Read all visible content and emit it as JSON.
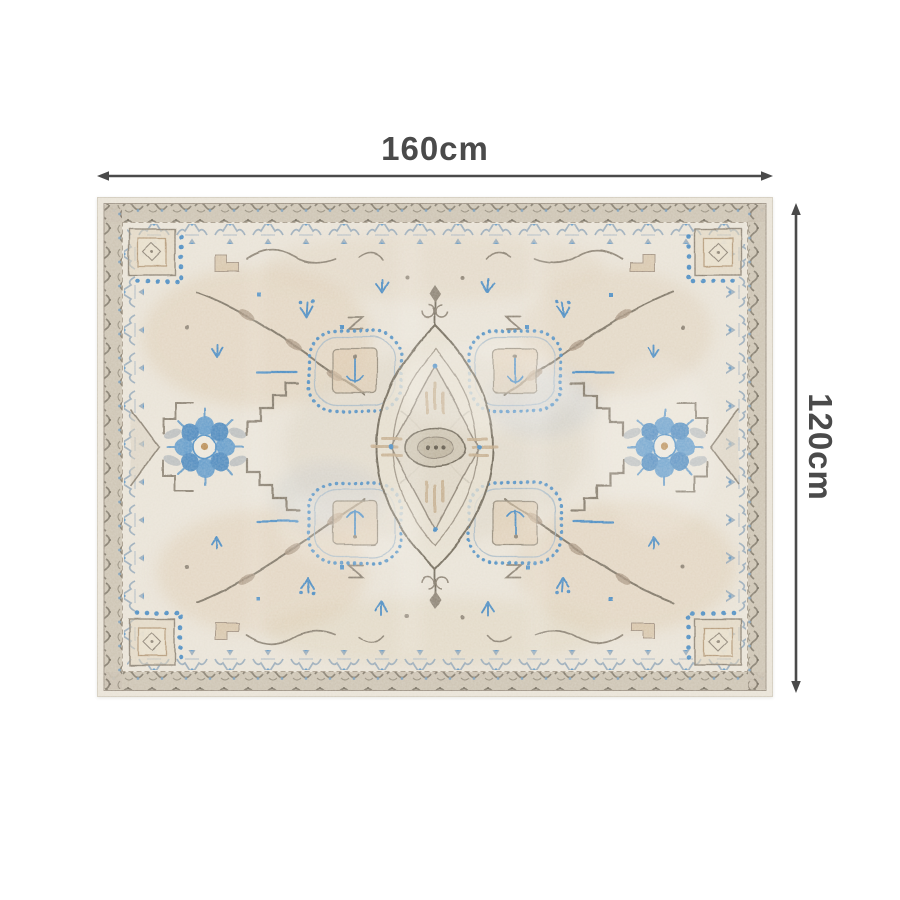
{
  "page": {
    "background_color": "#ffffff",
    "content_type": "product dimension diagram"
  },
  "dimension_annotations": {
    "arrow_color": "#4a4a4a",
    "width": {
      "label": "160cm"
    },
    "height": {
      "label": "120cm"
    }
  },
  "product_image": {
    "subject": "vintage distressed oriental medallion area rug, landscape orientation",
    "palette": {
      "base_cream": "#e9e3d7",
      "border_taupe": "#c9bfae",
      "ornament_gray_brown": "#857c6c",
      "accent_blue": "#4a8bc2",
      "accent_tan": "#d9c3a4",
      "guard_blue_gray": "#8ba1b4"
    }
  }
}
